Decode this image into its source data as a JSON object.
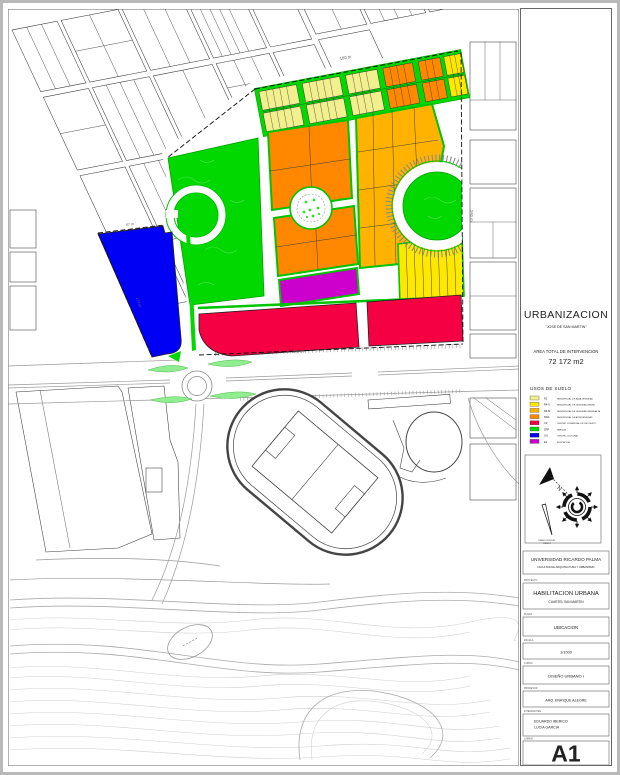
{
  "sheet": {
    "title": "URBANIZACION",
    "subtitle": "\"JOSE DE SAN MARTIN\"",
    "area_label": "AREA TOTAL DE INTERVENCION",
    "area_value": "72 172 m2"
  },
  "legend": {
    "heading": "USOS DE SUELO",
    "items": [
      {
        "code": "R2",
        "label": "RESIDENCIAL DE BAJA DENSIDAD",
        "color": "#F2F08E"
      },
      {
        "code": "R4-U",
        "label": "RESIDENCIAL DE DENSIDAD MEDIA",
        "color": "#FFE800"
      },
      {
        "code": "R4-M",
        "label": "RESIDENCIAL DE DENSIDAD MEDIA ALTA",
        "color": "#FFB300"
      },
      {
        "code": "RDA",
        "label": "RESIDENCIAL DE ALTA DENSIDAD",
        "color": "#FF8800"
      },
      {
        "code": "CZ",
        "label": "CENTRO COMERCIAL DE USO MIXTO",
        "color": "#F50042"
      },
      {
        "code": "ZRP",
        "label": "PARQUE",
        "color": "#00D800"
      },
      {
        "code": "OU",
        "label": "CENTRO CULTURAL",
        "color": "#0000F5"
      },
      {
        "code": "E1",
        "label": "EDUCACION",
        "color": "#CC00CC"
      }
    ]
  },
  "compass": {
    "north": "N",
    "caption1": "DIRECCION DEL",
    "caption2": "VIENTO"
  },
  "titleblock": {
    "university": "UNIVERSIDAD RICARDO PALMA",
    "faculty": "FACULTAD DE ARQUITECTURA Y URBANISMO",
    "project_label": "PROYECTO",
    "project": "HABILITACION URBANA",
    "project_sub": "CUARTEL SAN MARTIN",
    "plano_label": "PLANO",
    "plano": "UBICACION",
    "escala_label": "ESCALA",
    "escala": "1/1000",
    "curso_label": "CURSO",
    "curso": "DISEÑO URBANO I",
    "profesor_label": "PROFESOR",
    "profesor": "ARQ. ENRIQUE ALEGRE",
    "integrantes_label": "INTEGRANTES",
    "integrante1": "EDUARDO IBERICO",
    "integrante2": "LUCIA GARCIA",
    "lamina_label": "LAMINA",
    "lamina": "A1"
  },
  "map": {
    "dim_top": "180 m",
    "dim_bottom": "200 m",
    "dim_right": "260 m",
    "dim_blue_top": "87 m",
    "dim_blue_side": "174 m"
  },
  "colors": {
    "park_green": "#00D800",
    "light_green": "#90EE90",
    "orange": "#FF8800",
    "amber": "#FFB300",
    "yellow": "#FFE800",
    "pale_yellow": "#F2F08E",
    "red": "#F50042",
    "magenta": "#CC00CC",
    "blue": "#0000F5"
  }
}
